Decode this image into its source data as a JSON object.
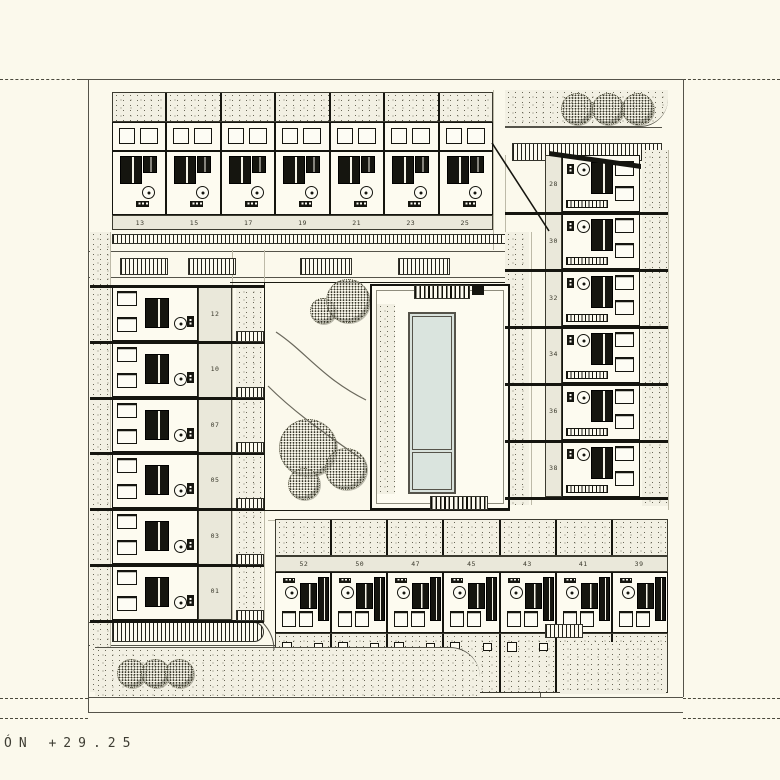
{
  "drawing": {
    "caption": "ÓN +29.25",
    "unit_rows": {
      "top": {
        "labels": [
          "13",
          "15",
          "17",
          "19",
          "21",
          "23",
          "25"
        ]
      },
      "left": {
        "labels": [
          "12",
          "10",
          "07",
          "05",
          "03",
          "01"
        ]
      },
      "right": {
        "labels": [
          "28",
          "30",
          "32",
          "34",
          "36",
          "38"
        ]
      },
      "bottom": {
        "labels": [
          "52",
          "50",
          "47",
          "45",
          "43",
          "41",
          "39"
        ]
      }
    },
    "colors": {
      "paper": "#fbf9ec",
      "ink": "#15150f",
      "line_grey": "#55544a",
      "ground_stipple": "#f2f0e3",
      "label_strip": "#eae8da",
      "pool_water": "#d9e2dc"
    }
  }
}
